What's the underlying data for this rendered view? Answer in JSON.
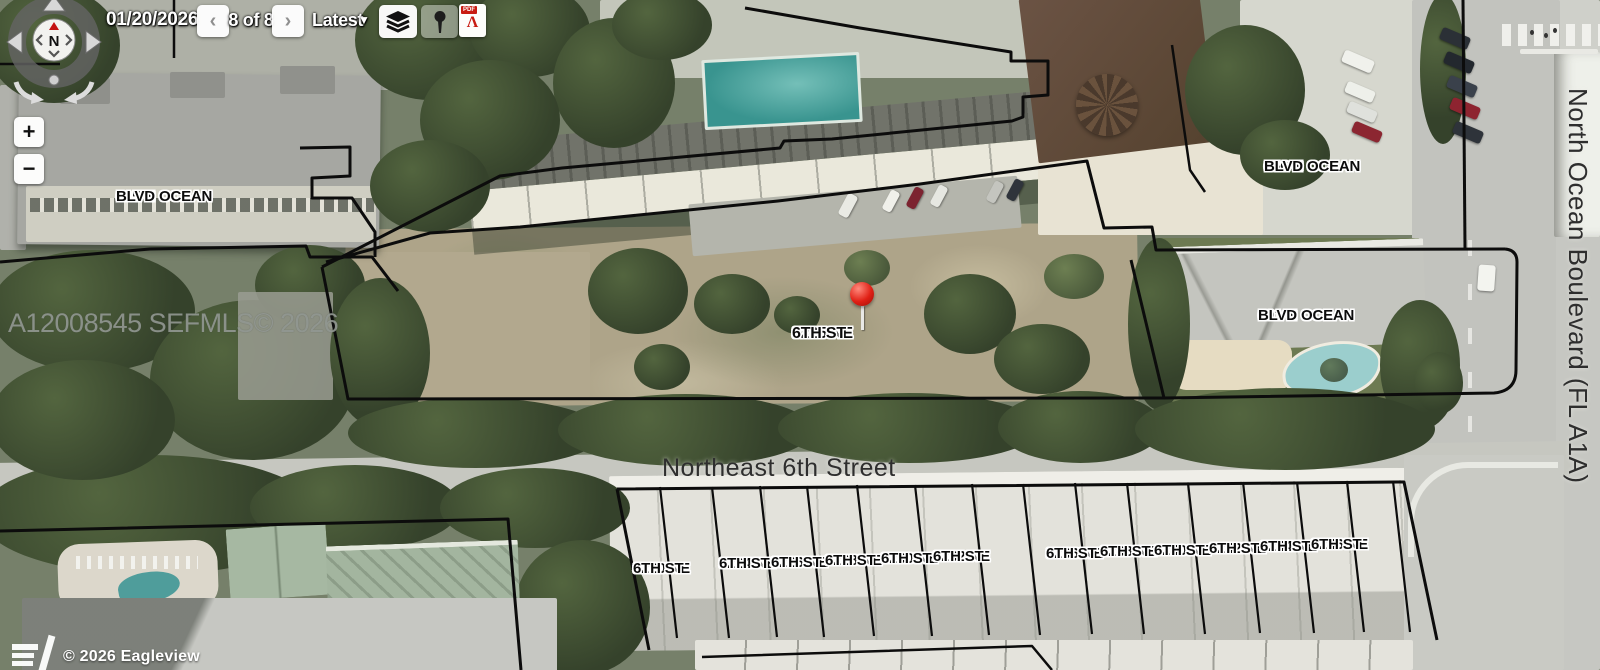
{
  "toolbar": {
    "date": "01/20/2026",
    "prev_label": "‹",
    "page_indicator": "8 of 8",
    "next_label": "›",
    "layer_dropdown": "Latest",
    "dropdown_caret": "▼",
    "pdf_label": "PDF"
  },
  "controls": {
    "compass_north": "N",
    "zoom_in": "+",
    "zoom_out": "−"
  },
  "map": {
    "watermark": "A12008545  SEFMLS© 2026",
    "attribution": "© 2026 Eagleview",
    "streets": {
      "horizontal": "Northeast 6th Street",
      "vertical": "North Ocean Boulevard (FL A1A)"
    },
    "pin": {
      "line1": "3225 NE",
      "line2": "6TH ST"
    },
    "addresses": [
      {
        "id": "615",
        "line1": "615 N OCEAN",
        "line2": "BLVD"
      },
      {
        "id": "656",
        "line1": "656 N OCEAN",
        "line2": "BLVD"
      },
      {
        "id": "601",
        "line1": "601 N OCEAN",
        "line2": "BLVD"
      }
    ],
    "parcels": [
      {
        "line1": "3220 NE",
        "line2": "6TH ST"
      },
      {
        "line1": "3224 NE",
        "line2": "6TH ST"
      },
      {
        "line1": "3226 NE",
        "line2": "6TH ST"
      },
      {
        "line1": "3228 NE",
        "line2": "6TH ST"
      },
      {
        "line1": "3230 NE",
        "line2": "6TH ST"
      },
      {
        "line1": "3232 NE",
        "line2": "6TH ST"
      },
      {
        "line1": "3236 NE",
        "line2": "6TH ST"
      },
      {
        "line1": "3238 NE",
        "line2": "6TH ST"
      },
      {
        "line1": "3240 NE",
        "line2": "6TH ST"
      },
      {
        "line1": "3242 NE",
        "line2": "6TH ST"
      },
      {
        "line1": "3244 NE",
        "line2": "6TH ST"
      },
      {
        "line1": "3246 NE",
        "line2": "6TH ST"
      }
    ]
  },
  "colors": {
    "parcel_line": "#0c0c0c",
    "pin_red": "#e02015",
    "pool_teal": "#3f9a95",
    "label_halo": "#ffffff"
  }
}
